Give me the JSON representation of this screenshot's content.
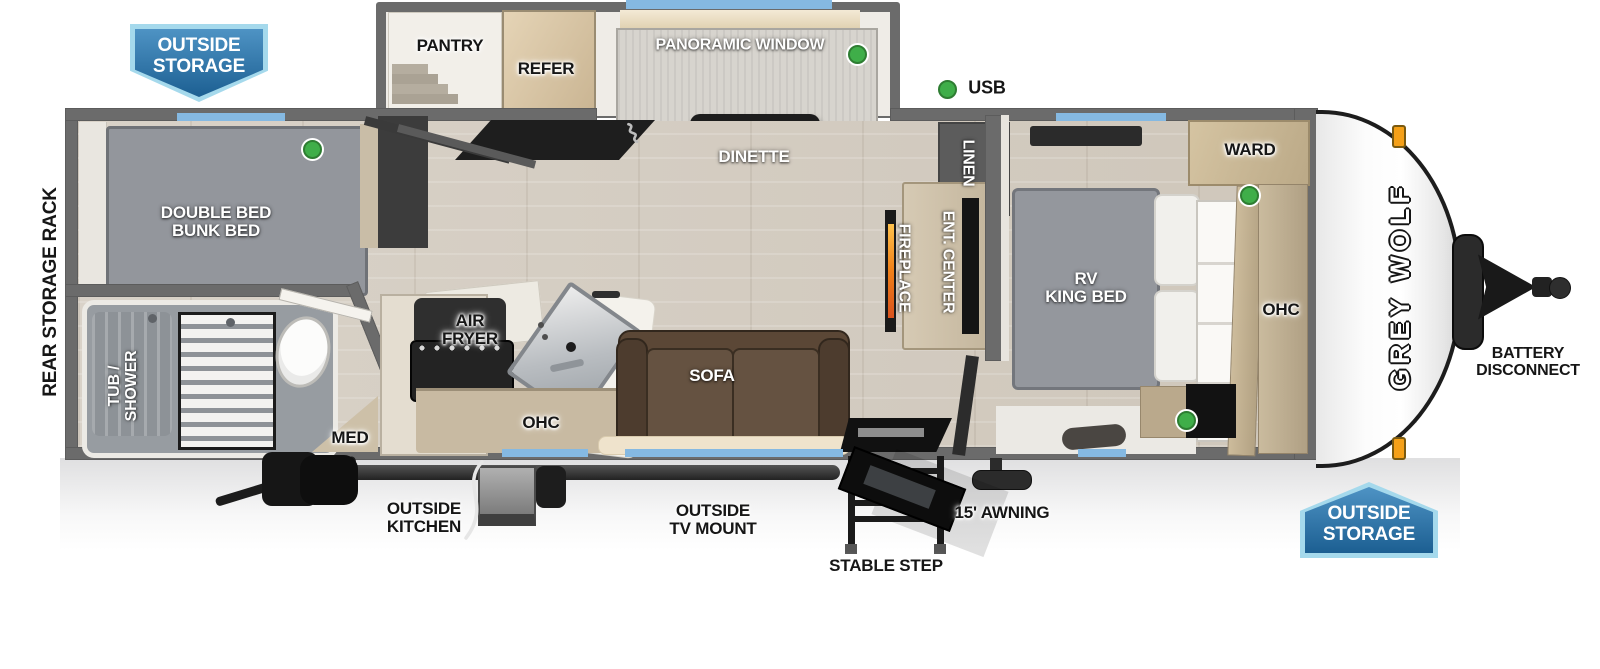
{
  "badges": {
    "top_left": "OUTSIDE\nSTORAGE",
    "bottom_right": "OUTSIDE\nSTORAGE"
  },
  "exterior": {
    "rear_storage_rack": "REAR STORAGE RACK",
    "usb_legend": "USB",
    "battery_disconnect": "BATTERY\nDISCONNECT",
    "outside_kitchen": "OUTSIDE\nKITCHEN",
    "outside_tv_mount": "OUTSIDE\nTV MOUNT",
    "stable_step": "STABLE STEP",
    "awning": "15' AWNING",
    "brand_logo": "GREY WOLF"
  },
  "interior": {
    "pantry": "PANTRY",
    "refer": "REFER",
    "panoramic_window": "PANORAMIC WINDOW",
    "dinette": "DINETTE",
    "double_bed_bunk": "DOUBLE BED\nBUNK BED",
    "tub_shower": "TUB /\nSHOWER",
    "med": "MED",
    "air_fryer": "AIR\nFRYER",
    "kitchen_ohc": "OHC",
    "sofa": "SOFA",
    "fireplace": "FIREPLACE",
    "ent_center": "ENT. CENTER",
    "linen": "LINEN",
    "rv_king_bed": "RV\nKING BED",
    "ward": "WARD",
    "bedroom_ohc": "OHC"
  },
  "legend": {
    "usb_indicator_meaning": "USB"
  },
  "colors": {
    "badge_blue_dark": "#1c5f92",
    "badge_blue_light": "#4e93c4",
    "badge_border": "#a5d9ec",
    "window_strip_blue": "#85b9e2",
    "usb_green": "#3fae49",
    "marker_light_orange": "#f5a018",
    "wall_gray": "#6b6b6b",
    "floor_wood": "#d6cfc5",
    "sofa_brown": "#5b4736",
    "fireplace_flame": "#f08019"
  }
}
